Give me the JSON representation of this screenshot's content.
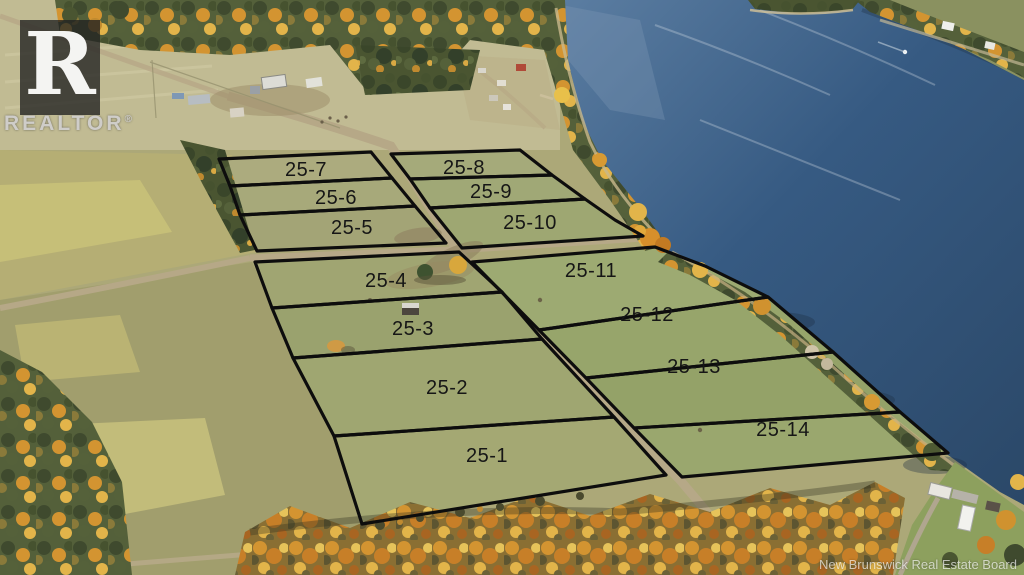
{
  "branding": {
    "logo_letter": "R",
    "wordmark": "REALTOR",
    "registered": "®"
  },
  "watermark": {
    "credit": "New Brunswick Real Estate Board"
  },
  "lots": [
    {
      "label": "25-1"
    },
    {
      "label": "25-2"
    },
    {
      "label": "25-3"
    },
    {
      "label": "25-4"
    },
    {
      "label": "25-5"
    },
    {
      "label": "25-6"
    },
    {
      "label": "25-7"
    },
    {
      "label": "25-8"
    },
    {
      "label": "25-9"
    },
    {
      "label": "25-10"
    },
    {
      "label": "25-11"
    },
    {
      "label": "25-12"
    },
    {
      "label": "25-13"
    },
    {
      "label": "25-14"
    }
  ],
  "palette": {
    "boundary_black": "#0d0d0d",
    "label_black": "#161616",
    "water_deep": "#2b4868",
    "water_light": "#5d7fa3",
    "field_base": "#aca878",
    "field_light": "#c5bf9a",
    "lot_grass": "#9da56f",
    "trees_dark": "#44502e",
    "autumn_orange": "#d0922f",
    "autumn_yellow": "#e2b84a",
    "road_tan": "#b6a887",
    "lawn_green": "#8da05e"
  }
}
